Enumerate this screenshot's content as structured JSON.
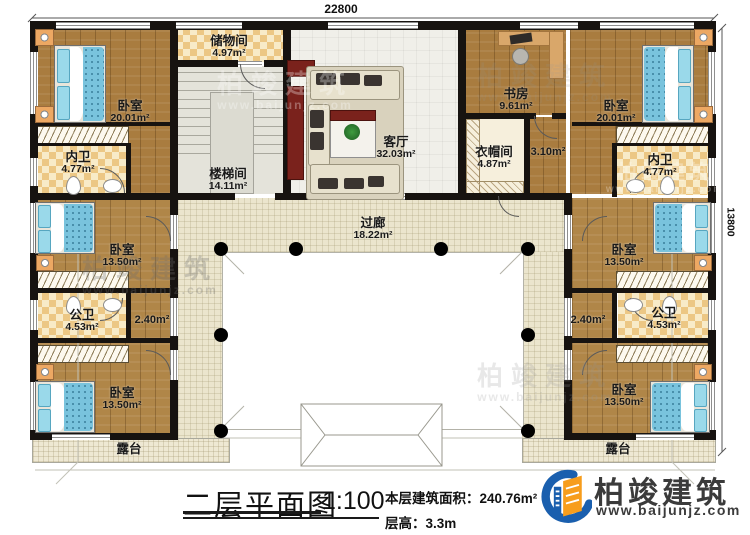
{
  "dimensions": {
    "top": "22800",
    "right": "13800"
  },
  "rooms": [
    {
      "name": "卧室",
      "area": "20.01m²"
    },
    {
      "name": "储物间",
      "area": "4.97m²"
    },
    {
      "name": "楼梯间",
      "area": "14.11m²"
    },
    {
      "name": "客厅",
      "area": "32.03m²"
    },
    {
      "name": "书房",
      "area": "9.61m²"
    },
    {
      "name": "卧室",
      "area": "20.01m²"
    },
    {
      "name": "内卫",
      "area": "4.77m²"
    },
    {
      "name": "衣帽间",
      "area": "4.87m²"
    },
    {
      "name": "内卫",
      "area": "4.77m²"
    },
    {
      "name": "过廊",
      "area": "18.22m²"
    },
    {
      "name": "卧室",
      "area": "13.50m²"
    },
    {
      "name": "卧室",
      "area": "13.50m²"
    },
    {
      "name": "公卫",
      "area": "4.53m²"
    },
    {
      "name": "公卫",
      "area": "4.53m²"
    },
    {
      "name": "卧室",
      "area": "13.50m²"
    },
    {
      "name": "卧室",
      "area": "13.50m²"
    },
    {
      "name": "露台",
      "area": ""
    },
    {
      "name": "露台",
      "area": ""
    }
  ],
  "corridor_areas": [
    {
      "area": "3.10m²"
    },
    {
      "area": "2.40m²"
    },
    {
      "area": "2.40m²"
    }
  ],
  "title_block": {
    "title": "二层平面图",
    "scale": "1:100",
    "area_label": "本层建筑面积：240.76m²",
    "floor_height": "层高：3.3m"
  },
  "logo": {
    "name": "柏竣建筑",
    "url": "www.baijunjz.com"
  },
  "watermark": {
    "name": "柏竣建筑",
    "url": "www.baijunjz.com"
  }
}
